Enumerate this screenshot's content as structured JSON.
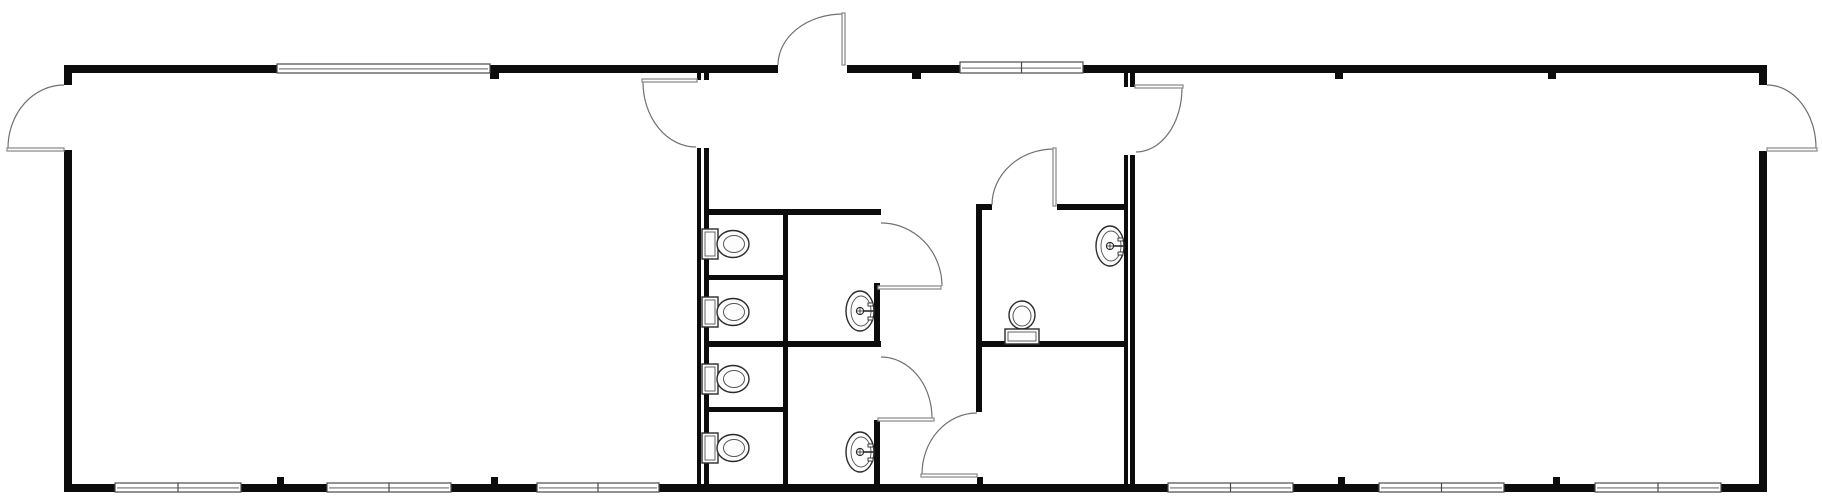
{
  "plan": {
    "canvas": {
      "width": 1822,
      "height": 496
    },
    "colors": {
      "background": "#ffffff",
      "wall": "#0c0c0c",
      "door_leaf": "#8f8f8f",
      "door_arc": "#707070",
      "fixture_stroke": "#2b2b2b",
      "fixture_fill": "#fdfdfd",
      "fixture_inner": "#555555",
      "window_stroke": "#4a4a4a",
      "window_fill": "#ffffff"
    },
    "walls": [
      {
        "name": "exterior-top-wall-left",
        "x": 64,
        "y": 65,
        "w": 714,
        "h": 8
      },
      {
        "name": "exterior-top-wall-right",
        "x": 847,
        "y": 65,
        "w": 920,
        "h": 8
      },
      {
        "name": "exterior-bottom-wall",
        "x": 64,
        "y": 484,
        "w": 1703,
        "h": 8
      },
      {
        "name": "exterior-left-wall-upper",
        "x": 64,
        "y": 65,
        "w": 8,
        "h": 20
      },
      {
        "name": "exterior-left-wall-lower",
        "x": 64,
        "y": 150,
        "w": 8,
        "h": 342
      },
      {
        "name": "exterior-right-wall-upper",
        "x": 1759,
        "y": 65,
        "w": 8,
        "h": 20
      },
      {
        "name": "exterior-right-wall-lower",
        "x": 1759,
        "y": 151,
        "w": 8,
        "h": 341
      },
      {
        "name": "unit-seam-left-a-upper",
        "x": 697,
        "y": 72,
        "w": 4,
        "h": 8
      },
      {
        "name": "unit-seam-left-a-lower",
        "x": 697,
        "y": 148,
        "w": 4,
        "h": 338
      },
      {
        "name": "unit-seam-left-b-upper",
        "x": 704,
        "y": 72,
        "w": 5,
        "h": 8
      },
      {
        "name": "unit-seam-left-b-lower",
        "x": 704,
        "y": 148,
        "w": 5,
        "h": 338
      },
      {
        "name": "unit-seam-right-a-upper",
        "x": 1124,
        "y": 72,
        "w": 4,
        "h": 15
      },
      {
        "name": "unit-seam-right-a-lower",
        "x": 1124,
        "y": 155,
        "w": 4,
        "h": 331
      },
      {
        "name": "unit-seam-right-b-upper",
        "x": 1130,
        "y": 72,
        "w": 5,
        "h": 15
      },
      {
        "name": "unit-seam-right-b-lower",
        "x": 1130,
        "y": 155,
        "w": 5,
        "h": 331
      },
      {
        "name": "restroom-top-wall",
        "x": 709,
        "y": 209,
        "w": 172,
        "h": 6
      },
      {
        "name": "restroom-separator-wall",
        "x": 709,
        "y": 341,
        "w": 172,
        "h": 6
      },
      {
        "name": "stall-divider-upper",
        "x": 709,
        "y": 275,
        "w": 78,
        "h": 5
      },
      {
        "name": "stall-divider-lower",
        "x": 709,
        "y": 407,
        "w": 78,
        "h": 5
      },
      {
        "name": "stall-front-wall",
        "x": 783,
        "y": 209,
        "w": 5,
        "h": 275
      },
      {
        "name": "restroom-east-wall-upper",
        "x": 874,
        "y": 283,
        "w": 6,
        "h": 64
      },
      {
        "name": "restroom-east-wall-lower",
        "x": 874,
        "y": 420,
        "w": 6,
        "h": 64
      },
      {
        "name": "wc-room-top-wall-left",
        "x": 976,
        "y": 204,
        "w": 16,
        "h": 6
      },
      {
        "name": "wc-room-top-wall-right",
        "x": 1057,
        "y": 204,
        "w": 67,
        "h": 6
      },
      {
        "name": "wc-room-west-wall",
        "x": 976,
        "y": 204,
        "w": 6,
        "h": 208
      },
      {
        "name": "wc-storage-separator-wall",
        "x": 976,
        "y": 341,
        "w": 148,
        "h": 6
      }
    ],
    "wall_ticks": [
      {
        "name": "wall-joint-tick",
        "x": 490,
        "y": 72,
        "w": 9,
        "h": 7
      },
      {
        "name": "wall-joint-tick",
        "x": 912,
        "y": 72,
        "w": 9,
        "h": 7
      },
      {
        "name": "wall-joint-tick",
        "x": 1335,
        "y": 72,
        "w": 8,
        "h": 7
      },
      {
        "name": "wall-joint-tick",
        "x": 1548,
        "y": 72,
        "w": 8,
        "h": 7
      },
      {
        "name": "wall-joint-tick",
        "x": 277,
        "y": 477,
        "w": 7,
        "h": 8
      },
      {
        "name": "wall-joint-tick",
        "x": 491,
        "y": 477,
        "w": 7,
        "h": 8
      },
      {
        "name": "wall-joint-tick",
        "x": 977,
        "y": 477,
        "w": 6,
        "h": 8
      },
      {
        "name": "wall-joint-tick",
        "x": 1338,
        "y": 477,
        "w": 7,
        "h": 8
      },
      {
        "name": "wall-joint-tick",
        "x": 1553,
        "y": 477,
        "w": 7,
        "h": 8
      }
    ],
    "windows": [
      {
        "name": "window-band",
        "x": 277,
        "y": 64,
        "w": 213,
        "h": 9,
        "panes": 1
      },
      {
        "name": "window-band",
        "x": 960,
        "y": 62,
        "w": 123,
        "h": 11,
        "panes": 2
      },
      {
        "name": "window-band",
        "x": 115,
        "y": 483,
        "w": 126,
        "h": 9,
        "panes": 2
      },
      {
        "name": "window-band",
        "x": 327,
        "y": 483,
        "w": 124,
        "h": 9,
        "panes": 2
      },
      {
        "name": "window-band",
        "x": 537,
        "y": 483,
        "w": 122,
        "h": 9,
        "panes": 2
      },
      {
        "name": "window-band",
        "x": 1168,
        "y": 483,
        "w": 125,
        "h": 9,
        "panes": 2
      },
      {
        "name": "window-band",
        "x": 1379,
        "y": 483,
        "w": 125,
        "h": 9,
        "panes": 2
      },
      {
        "name": "window-band",
        "x": 1595,
        "y": 483,
        "w": 126,
        "h": 9,
        "panes": 2
      }
    ],
    "doors": [
      {
        "name": "left-exterior-door",
        "leaf": {
          "x": 7,
          "y": 148,
          "w": 57,
          "h": 3
        },
        "arc": {
          "x1": 64,
          "y1": 85,
          "x2": 8,
          "y2": 148,
          "sweep": 0
        }
      },
      {
        "name": "right-exterior-door",
        "leaf": {
          "x": 1767,
          "y": 148,
          "w": 50,
          "h": 3
        },
        "arc": {
          "x1": 1767,
          "y1": 85,
          "x2": 1816,
          "y2": 148,
          "sweep": 1
        }
      },
      {
        "name": "entry-exterior-door",
        "leaf": {
          "x": 842,
          "y": 13,
          "w": 3,
          "h": 52
        },
        "arc": {
          "x1": 778,
          "y1": 65,
          "x2": 843,
          "y2": 14,
          "sweep": 1
        }
      },
      {
        "name": "left-room-door",
        "leaf": {
          "x": 642,
          "y": 79,
          "w": 55,
          "h": 3
        },
        "arc": {
          "x1": 643,
          "y1": 82,
          "x2": 696,
          "y2": 147,
          "sweep": 0
        }
      },
      {
        "name": "right-room-door",
        "leaf": {
          "x": 1135,
          "y": 85,
          "w": 48,
          "h": 3
        },
        "arc": {
          "x1": 1182,
          "y1": 88,
          "x2": 1136,
          "y2": 152,
          "sweep": 1
        }
      },
      {
        "name": "restroom-upper-door",
        "leaf": {
          "x": 878,
          "y": 286,
          "w": 63,
          "h": 3
        },
        "arc": {
          "x1": 881,
          "y1": 223,
          "x2": 942,
          "y2": 286,
          "sweep": 1
        }
      },
      {
        "name": "restroom-lower-door",
        "leaf": {
          "x": 878,
          "y": 418,
          "w": 56,
          "h": 3
        },
        "arc": {
          "x1": 881,
          "y1": 357,
          "x2": 932,
          "y2": 418,
          "sweep": 1
        }
      },
      {
        "name": "wc-room-door",
        "leaf": {
          "x": 1053,
          "y": 148,
          "w": 3,
          "h": 58
        },
        "arc": {
          "x1": 992,
          "y1": 205,
          "x2": 1054,
          "y2": 149,
          "sweep": 1
        }
      },
      {
        "name": "storage-room-door",
        "leaf": {
          "x": 921,
          "y": 474,
          "w": 56,
          "h": 3
        },
        "arc": {
          "x1": 977,
          "y1": 413,
          "x2": 922,
          "y2": 474,
          "sweep": 0
        }
      }
    ],
    "toilets": [
      {
        "name": "toilet-icon",
        "facing": "east",
        "tank_x": 702,
        "cx": 733,
        "cy": 244
      },
      {
        "name": "toilet-icon",
        "facing": "east",
        "tank_x": 702,
        "cx": 733,
        "cy": 312
      },
      {
        "name": "toilet-icon",
        "facing": "east",
        "tank_x": 702,
        "cx": 733,
        "cy": 379
      },
      {
        "name": "toilet-icon",
        "facing": "east",
        "tank_x": 702,
        "cx": 733,
        "cy": 448
      }
    ],
    "wc_toilet": {
      "name": "toilet-icon",
      "facing": "north",
      "cx": 1022,
      "cy": 315,
      "tank_y": 329
    },
    "sinks": [
      {
        "name": "sink-icon",
        "wall_x": 874,
        "cx": 860,
        "cy": 311
      },
      {
        "name": "sink-icon",
        "wall_x": 874,
        "cx": 860,
        "cy": 452
      },
      {
        "name": "sink-icon",
        "wall_x": 1124,
        "cx": 1110,
        "cy": 246
      }
    ]
  }
}
